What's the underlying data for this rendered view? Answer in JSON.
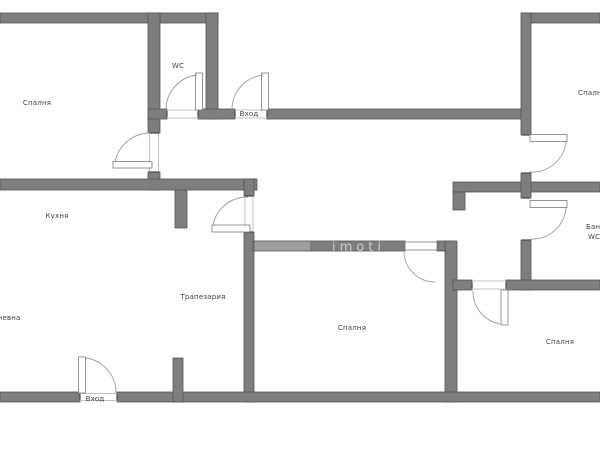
{
  "title": "Apartment floor plan",
  "colors": {
    "background": "#ffffff",
    "wall_fill": "#7e7e7e",
    "wall_stroke": "#545454",
    "door_sill": "#b0b0b0",
    "door_arc": "#9b9b9b",
    "label_text": "#3f3f3f",
    "watermark_on_wall": "rgba(255,255,255,0.6)"
  },
  "watermark": {
    "text": "imoti"
  },
  "labels": {
    "bedroom_top_left": "Спалня",
    "wc": "WC",
    "entry_top": "Вход",
    "bedroom_top_right": "Спалня",
    "kitchen": "Кухня",
    "dining": "Трапезария",
    "living": "Дневна",
    "bedroom_bottom_middle": "Спалня",
    "bedroom_bottom_right": "Спалня",
    "entry_bottom": "Вход",
    "bath_line1": "Баня",
    "bath_line2": "WC"
  }
}
